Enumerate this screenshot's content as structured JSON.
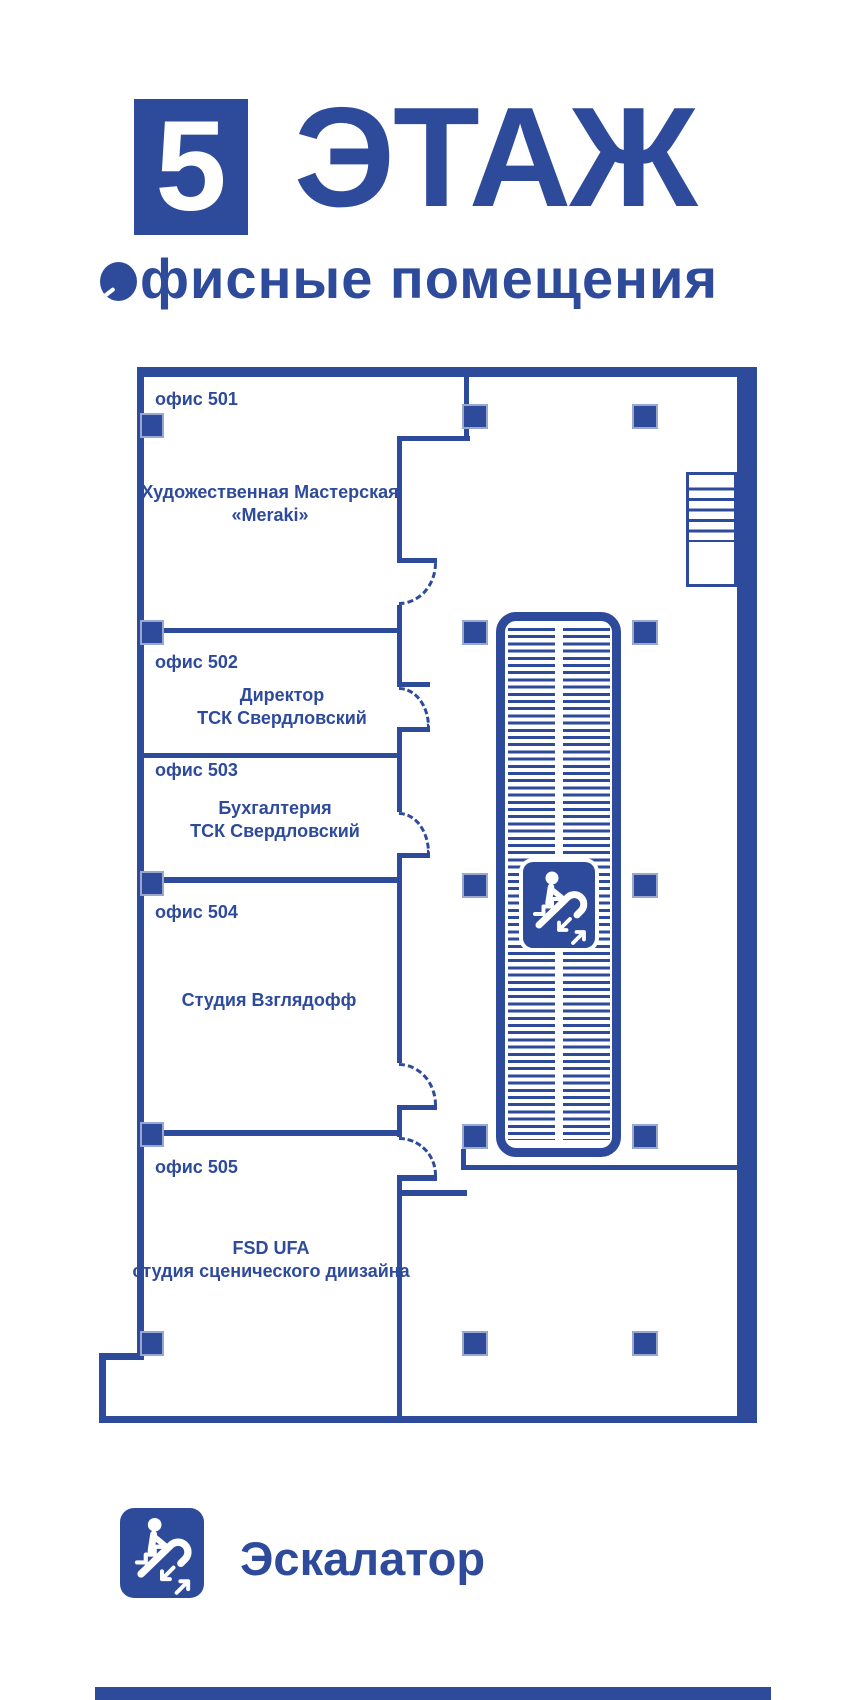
{
  "theme": {
    "primary_blue": "#2e4b9b"
  },
  "header": {
    "floor_number": "5",
    "floor_title": "ЭТАЖ",
    "subtitle_initial": "О",
    "subtitle_rest": "фисные помещения"
  },
  "offices": [
    {
      "label": "офис 501",
      "line1": "Художественная Мастерская",
      "line2": "«Meraki»"
    },
    {
      "label": "офис 502",
      "line1": "Директор",
      "line2": "ТСК Свердловский"
    },
    {
      "label": "офис 503",
      "line1": "Бухгалтерия",
      "line2": "ТСК Свердловский"
    },
    {
      "label": "офис 504",
      "line1": "Студия Взглядофф"
    },
    {
      "label": "офис 505",
      "line1": "FSD UFA",
      "line2": "студия сценического диизайна"
    }
  ],
  "legend": {
    "icon": "escalator-icon",
    "label": "Эскалатор"
  }
}
